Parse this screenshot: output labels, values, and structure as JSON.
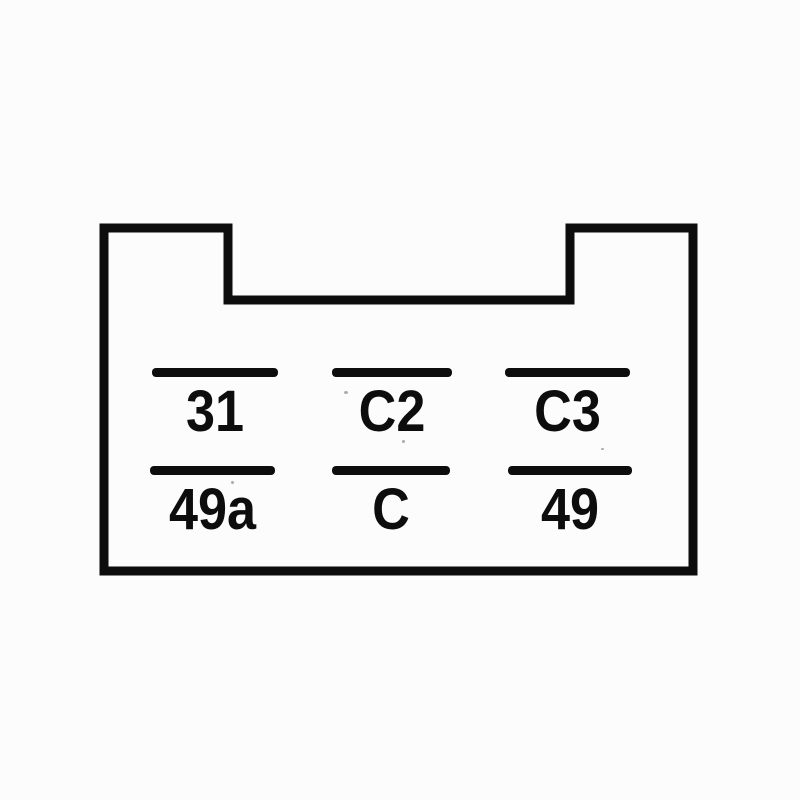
{
  "diagram": {
    "kind": "relay-socket-pinout",
    "colors": {
      "ink": "#0d0d0d",
      "paper": "#fcfcfc"
    },
    "pins": [
      {
        "label": "31"
      },
      {
        "label": "C2"
      },
      {
        "label": "C3"
      },
      {
        "label": "49a"
      },
      {
        "label": "C"
      },
      {
        "label": "49"
      }
    ]
  }
}
